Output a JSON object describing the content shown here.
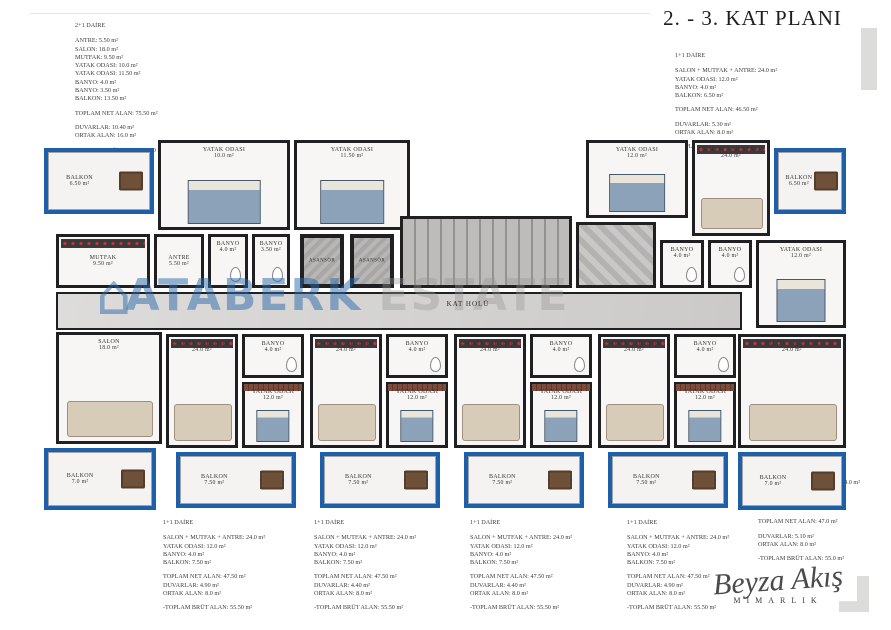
{
  "title": "2. - 3. KAT PLANI",
  "watermark": {
    "left": "ATABERK",
    "right": "ESTATE"
  },
  "architect": {
    "script": "Beyza Akış",
    "sub": "MİMARLIK"
  },
  "colors": {
    "balcony_accent": "#1d5fa8",
    "wall": "#202022",
    "watermark_blue": "#2b68aa"
  },
  "info_blocks": [
    {
      "title": "2+1 DAİRE",
      "lines": [
        "ANTRE: 5.50 m²",
        "SALON: 18.0 m²",
        "MUTFAK: 9.50 m²",
        "YATAK ODASI: 10.0 m²",
        "YATAK ODASI: 11.50 m²",
        "BANYO: 4.0 m²",
        "BANYO: 3.50 m²",
        "BALKON: 13.50 m²",
        "",
        "TOPLAM NET ALAN: 75.50 m²",
        "",
        "DUVARLAR: 10.40 m²",
        "ORTAK ALAN: 16.0 m²",
        "",
        "-TOPLAM BRÜT ALAN: 91.50 m²"
      ]
    },
    {
      "title": "1+1 DAİRE",
      "lines": [
        "SALON + MUTFAK + ANTRE: 24.0 m²",
        "YATAK ODASI: 12.0 m²",
        "BANYO: 4.0 m²",
        "BALKON: 6.50 m²",
        "",
        "TOPLAM NET ALAN: 46.50 m²",
        "",
        "DUVARLAR: 5.30 m²",
        "ORTAK ALAN: 8.0 m²",
        "",
        "-TOPLAM BRÜT ALAN: 54.50 m²"
      ]
    },
    {
      "title": "1+1 DAİRE",
      "lines": [
        "SALON + MUTFAK + ANTRE: 24.0 m²",
        "YATAK ODASI: 12.0 m²",
        "BANYO: 4.0 m²",
        "BALKON: 7.50 m²",
        "",
        "TOPLAM NET ALAN: 47.50 m²",
        "DUVARLAR: 4.90 m²",
        "ORTAK ALAN: 8.0 m²",
        "",
        "-TOPLAM BRÜT ALAN: 55.50 m²"
      ]
    },
    {
      "title": "1+1 DAİRE",
      "lines": [
        "SALON + MUTFAK + ANTRE: 24.0 m²",
        "YATAK ODASI: 12.0 m²",
        "BANYO: 4.0 m²",
        "BALKON: 7.50 m²",
        "",
        "TOPLAM NET ALAN: 47.50 m²",
        "DUVARLAR: 4.40 m²",
        "ORTAK ALAN: 8.0 m²",
        "",
        "-TOPLAM BRÜT ALAN: 55.50 m²"
      ]
    },
    {
      "title": "1+1 DAİRE",
      "lines": [
        "SALON + MUTFAK + ANTRE: 24.0 m²",
        "YATAK ODASI: 12.0 m²",
        "BANYO: 4.0 m²",
        "BALKON: 7.50 m²",
        "",
        "TOPLAM NET ALAN: 47.50 m²",
        "DUVARLAR: 4.40 m²",
        "ORTAK ALAN: 8.0 m²",
        "",
        "-TOPLAM BRÜT ALAN: 55.50 m²"
      ]
    },
    {
      "title": "1+1 DAİRE",
      "lines": [
        "SALON + MUTFAK + ANTRE: 24.0 m²",
        "YATAK ODASI: 12.0 m²",
        "BANYO: 4.0 m²",
        "BALKON: 7.50 m²",
        "",
        "TOPLAM NET ALAN: 47.50 m²",
        "DUVARLAR: 4.90 m²",
        "ORTAK ALAN: 8.0 m²",
        "",
        "-TOPLAM BRÜT ALAN: 55.50 m²"
      ]
    },
    {
      "title": "1+1 DAİRE",
      "lines": [
        "SALON + MUTFAK + ANTRE: 24.0 m²",
        "YATAK ODASI: 12.0 m²",
        "BANYO: 4.0 m²",
        "BALKON: 7.0 m²",
        "",
        "TOPLAM NET ALAN: 47.0 m²",
        "",
        "DUVARLAR: 5.10 m²",
        "ORTAK ALAN: 8.0 m²",
        "",
        "-TOPLAM BRÜT ALAN: 55.0 m²"
      ]
    }
  ],
  "block_positions": [
    {
      "left": 75,
      "top": 22,
      "width": 150
    },
    {
      "left": 675,
      "top": 52,
      "width": 175
    },
    {
      "left": 163,
      "top": 519,
      "width": 145
    },
    {
      "left": 314,
      "top": 519,
      "width": 145
    },
    {
      "left": 470,
      "top": 519,
      "width": 145
    },
    {
      "left": 627,
      "top": 519,
      "width": 145
    },
    {
      "left": 758,
      "top": 464,
      "width": 130
    }
  ],
  "plan": {
    "hall_label": "KAT HOLÜ",
    "rooms": [
      {
        "name": "balcony-2plus1-top",
        "type": "balcony",
        "furn": "table",
        "x": 6,
        "y": 10,
        "w": 110,
        "h": 66,
        "label": "BALKON",
        "area": "6.50 m²"
      },
      {
        "name": "bedroom-10",
        "type": "room",
        "furn": "bed",
        "x": 120,
        "y": 2,
        "w": 132,
        "h": 90,
        "label": "YATAK ODASI",
        "area": "10.0 m²"
      },
      {
        "name": "bedroom-1150",
        "type": "room",
        "furn": "bed",
        "x": 256,
        "y": 2,
        "w": 116,
        "h": 90,
        "label": "YATAK ODASI",
        "area": "11.50 m²"
      },
      {
        "name": "kitchen-950",
        "type": "room",
        "kitchen": true,
        "x": 18,
        "y": 96,
        "w": 94,
        "h": 54,
        "label": "MUTFAK",
        "area": "9.50 m²"
      },
      {
        "name": "antre-550",
        "type": "room",
        "x": 116,
        "y": 96,
        "w": 50,
        "h": 54,
        "label": "ANTRE",
        "area": "5.50 m²"
      },
      {
        "name": "banyo-40-left",
        "type": "room",
        "furn": "wc",
        "x": 170,
        "y": 96,
        "w": 40,
        "h": 54,
        "label": "BANYO",
        "area": "4.0 m²"
      },
      {
        "name": "banyo-350",
        "type": "room",
        "furn": "wc",
        "x": 214,
        "y": 96,
        "w": 38,
        "h": 54,
        "label": "BANYO",
        "area": "3.50 m²"
      },
      {
        "name": "salon-18",
        "type": "room",
        "furn": "sofa",
        "x": 18,
        "y": 194,
        "w": 106,
        "h": 112,
        "label": "SALON",
        "area": "18.0 m²"
      },
      {
        "name": "balcony-70-left",
        "type": "balcony",
        "furn": "table",
        "x": 6,
        "y": 310,
        "w": 112,
        "h": 62,
        "label": "BALKON",
        "area": "7.0 m²"
      },
      {
        "name": "elevator-1",
        "type": "core",
        "x": 262,
        "y": 96,
        "w": 44,
        "h": 54,
        "label": "ASANSÖR"
      },
      {
        "name": "elevator-2",
        "type": "core",
        "x": 312,
        "y": 96,
        "w": 44,
        "h": 54,
        "label": "ASANSÖR"
      },
      {
        "name": "staircase",
        "type": "stairs",
        "x": 362,
        "y": 78,
        "w": 172,
        "h": 72
      },
      {
        "name": "shaft",
        "type": "shaft",
        "x": 538,
        "y": 84,
        "w": 80,
        "h": 66
      },
      {
        "name": "hall",
        "type": "hall",
        "x": 18,
        "y": 154,
        "w": 686,
        "h": 38,
        "label": "KAT HOLÜ"
      },
      {
        "name": "bedroom-12-top-right",
        "type": "room",
        "furn": "bed",
        "x": 548,
        "y": 2,
        "w": 102,
        "h": 78,
        "label": "YATAK ODASI",
        "area": "12.0 m²"
      },
      {
        "name": "salon-mutfak-top-right",
        "type": "room",
        "furn": "sofa",
        "kitchen": true,
        "x": 654,
        "y": 2,
        "w": 78,
        "h": 96,
        "label": "SALON + MUTFAK",
        "area": "24.0 m²"
      },
      {
        "name": "balcony-650-right",
        "type": "balcony",
        "furn": "table",
        "x": 736,
        "y": 10,
        "w": 72,
        "h": 66,
        "label": "BALKON",
        "area": "6.50 m²"
      },
      {
        "name": "banyo-40-right-1",
        "type": "room",
        "furn": "wc",
        "x": 622,
        "y": 102,
        "w": 44,
        "h": 48,
        "label": "BANYO",
        "area": "4.0 m²"
      },
      {
        "name": "banyo-40-right-2",
        "type": "room",
        "furn": "wc",
        "x": 670,
        "y": 102,
        "w": 44,
        "h": 48,
        "label": "BANYO",
        "area": "4.0 m²"
      },
      {
        "name": "bedroom-12-right",
        "type": "room",
        "furn": "bed",
        "x": 718,
        "y": 102,
        "w": 90,
        "h": 88,
        "label": "YATAK ODASI",
        "area": "12.0 m²"
      },
      {
        "name": "salon-mutfak-right",
        "type": "room",
        "furn": "sofa",
        "kitchen": true,
        "x": 700,
        "y": 196,
        "w": 108,
        "h": 114,
        "label": "SALON + MUTFAK",
        "area": "24.0 m²"
      },
      {
        "name": "balcony-70-right",
        "type": "balcony",
        "furn": "table",
        "x": 700,
        "y": 314,
        "w": 108,
        "h": 58,
        "label": "BALKON",
        "area": "7.0 m²"
      },
      {
        "name": "unit1-salon-mutfak",
        "type": "room",
        "furn": "sofa",
        "kitchen": true,
        "x": 128,
        "y": 196,
        "w": 72,
        "h": 114,
        "label": "SALON + MUTFAK",
        "area": "24.0 m²"
      },
      {
        "name": "unit1-banyo",
        "type": "room",
        "furn": "wc",
        "x": 204,
        "y": 196,
        "w": 62,
        "h": 44,
        "label": "BANYO",
        "area": "4.0 m²"
      },
      {
        "name": "unit1-bedroom",
        "type": "room",
        "furn": "bed",
        "cls": "terr",
        "x": 204,
        "y": 244,
        "w": 62,
        "h": 66,
        "label": "YATAK ODASI",
        "area": "12.0 m²"
      },
      {
        "name": "unit1-balcony",
        "type": "balcony",
        "furn": "table",
        "x": 138,
        "y": 314,
        "w": 120,
        "h": 56,
        "label": "BALKON",
        "area": "7.50 m²"
      },
      {
        "name": "unit2-salon-mutfak",
        "type": "room",
        "furn": "sofa",
        "kitchen": true,
        "x": 272,
        "y": 196,
        "w": 72,
        "h": 114,
        "label": "SALON + MUTFAK",
        "area": "24.0 m²"
      },
      {
        "name": "unit2-banyo",
        "type": "room",
        "furn": "wc",
        "x": 348,
        "y": 196,
        "w": 62,
        "h": 44,
        "label": "BANYO",
        "area": "4.0 m²"
      },
      {
        "name": "unit2-bedroom",
        "type": "room",
        "furn": "bed",
        "cls": "terr",
        "x": 348,
        "y": 244,
        "w": 62,
        "h": 66,
        "label": "YATAK ODASI",
        "area": "12.0 m²"
      },
      {
        "name": "unit2-balcony",
        "type": "balcony",
        "furn": "table",
        "x": 282,
        "y": 314,
        "w": 120,
        "h": 56,
        "label": "BALKON",
        "area": "7.50 m²"
      },
      {
        "name": "unit3-salon-mutfak",
        "type": "room",
        "furn": "sofa",
        "kitchen": true,
        "x": 416,
        "y": 196,
        "w": 72,
        "h": 114,
        "label": "SALON + MUTFAK",
        "area": "24.0 m²"
      },
      {
        "name": "unit3-banyo",
        "type": "room",
        "furn": "wc",
        "x": 492,
        "y": 196,
        "w": 62,
        "h": 44,
        "label": "BANYO",
        "area": "4.0 m²"
      },
      {
        "name": "unit3-bedroom",
        "type": "room",
        "furn": "bed",
        "cls": "terr",
        "x": 492,
        "y": 244,
        "w": 62,
        "h": 66,
        "label": "YATAK ODASI",
        "area": "12.0 m²"
      },
      {
        "name": "unit3-balcony",
        "type": "balcony",
        "furn": "table",
        "x": 426,
        "y": 314,
        "w": 120,
        "h": 56,
        "label": "BALKON",
        "area": "7.50 m²"
      },
      {
        "name": "unit4-salon-mutfak",
        "type": "room",
        "furn": "sofa",
        "kitchen": true,
        "x": 560,
        "y": 196,
        "w": 72,
        "h": 114,
        "label": "SALON + MUTFAK",
        "area": "24.0 m²"
      },
      {
        "name": "unit4-banyo",
        "type": "room",
        "furn": "wc",
        "x": 636,
        "y": 196,
        "w": 62,
        "h": 44,
        "label": "BANYO",
        "area": "4.0 m²"
      },
      {
        "name": "unit4-bedroom",
        "type": "room",
        "furn": "bed",
        "cls": "terr",
        "x": 636,
        "y": 244,
        "w": 62,
        "h": 66,
        "label": "YATAK ODASI",
        "area": "12.0 m²"
      },
      {
        "name": "unit4-balcony",
        "type": "balcony",
        "furn": "table",
        "x": 570,
        "y": 314,
        "w": 120,
        "h": 56,
        "label": "BALKON",
        "area": "7.50 m²"
      }
    ]
  }
}
